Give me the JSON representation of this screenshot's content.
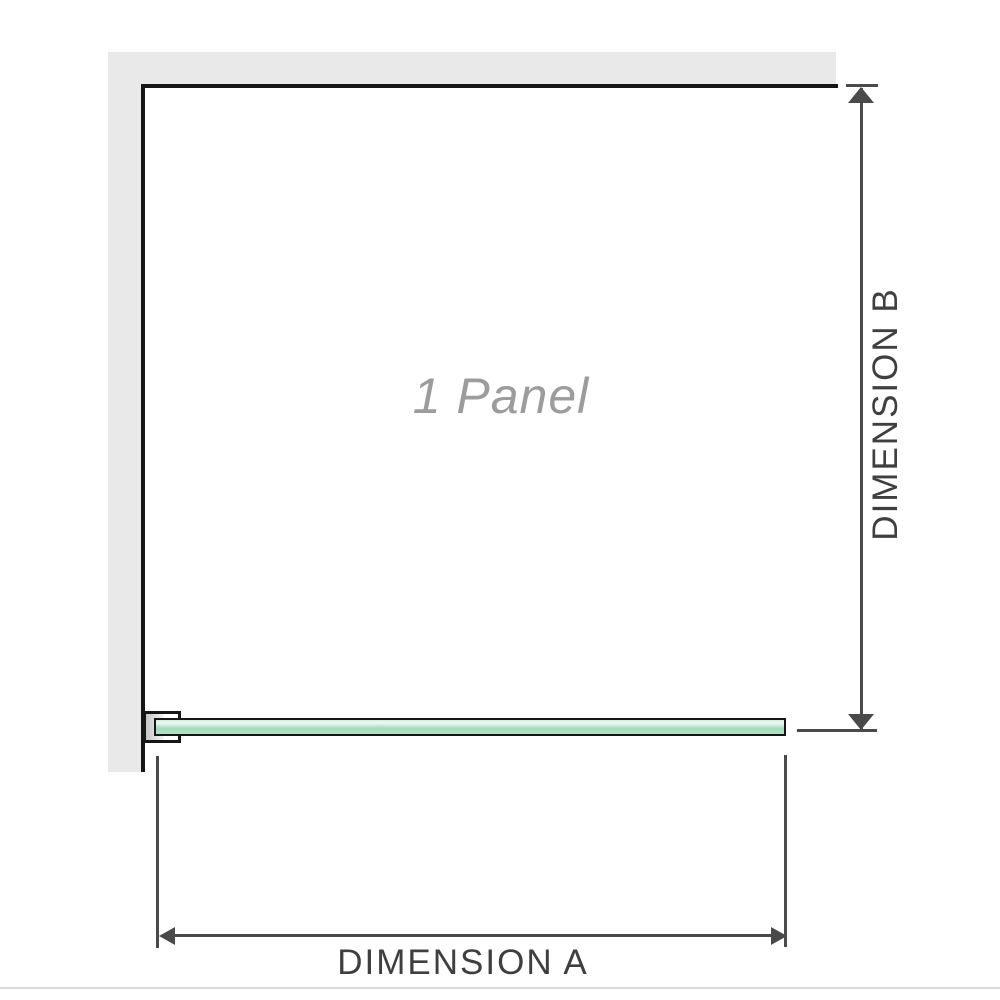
{
  "diagram": {
    "panel_label": "1 Panel",
    "dimension_a_label": "DIMENSION A",
    "dimension_b_label": "DIMENSION B"
  },
  "colors": {
    "wall": "#e9e9e9",
    "outline": "#161616",
    "dimension_line": "#4a4a4a",
    "label_text": "#3f3f3f",
    "panel_text": "#9c9c9c",
    "glass_fill": "#a5d9bc",
    "glass_fill_light": "#d4efe0",
    "glass_border": "#161616",
    "divider": "#dcdcdc"
  }
}
